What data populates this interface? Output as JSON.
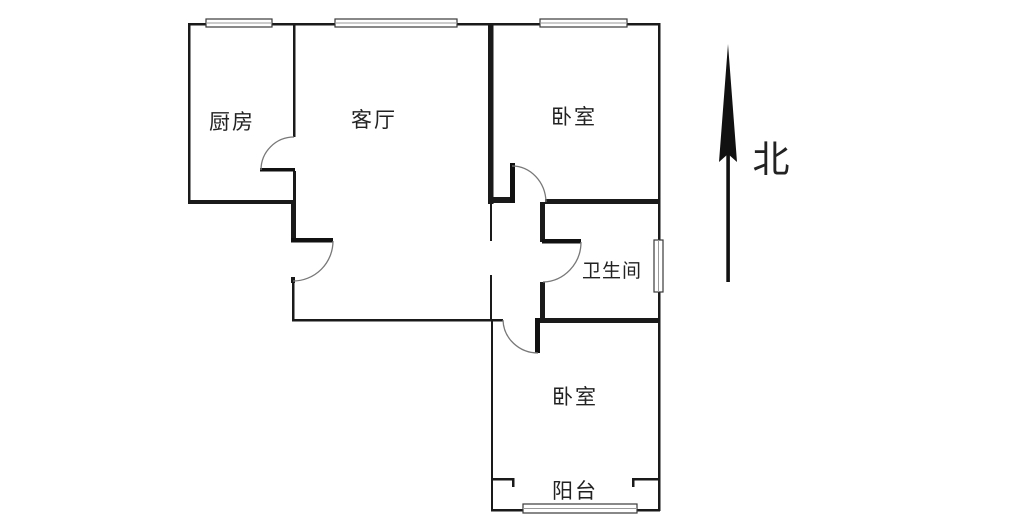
{
  "plan": {
    "rooms": {
      "kitchen": {
        "label": "厨房"
      },
      "living": {
        "label": "客厅"
      },
      "bedroom_north": {
        "label": "卧室"
      },
      "bathroom": {
        "label": "卫生间"
      },
      "bedroom_south": {
        "label": "卧室"
      },
      "balcony": {
        "label": "阳台"
      }
    },
    "compass": {
      "label": "北",
      "icon": "north-arrow-icon"
    },
    "colors": {
      "wall": "#1a1a1a",
      "door_leaf": "#111111",
      "arc": "#787878",
      "window_border": "#3a3a3a",
      "window_inner": "#9a9a9a",
      "label_text": "#222222",
      "background": "#ffffff"
    }
  }
}
